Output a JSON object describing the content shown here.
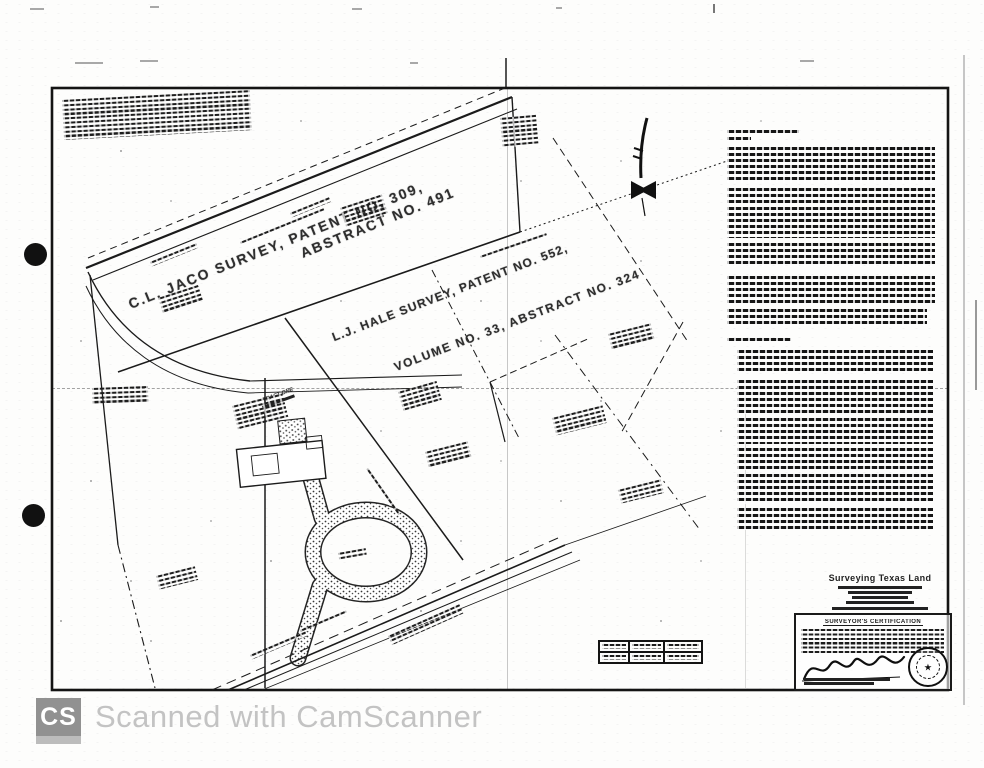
{
  "plat": {
    "surveys": {
      "jaco_line1": "C.L. JACO SURVEY, PATENT NO. 309,",
      "jaco_line2": "ABSTRACT NO. 491",
      "hale_line1": "L.J. HALE SURVEY, PATENT NO. 552,",
      "hale_line2": "VOLUME NO. 33, ABSTRACT NO. 324"
    },
    "tract_one_label": "TRACT ONE",
    "firm_name": "Surveying Texas Land",
    "certification_title": "SURVEYOR'S CERTIFICATION"
  },
  "watermark": {
    "badge_text": "CS",
    "caption": "Scanned with CamScanner"
  },
  "colors": {
    "ink": "#1b1b1b",
    "watermark_gray": "#c3c3c3",
    "badge_gray": "#919191"
  }
}
